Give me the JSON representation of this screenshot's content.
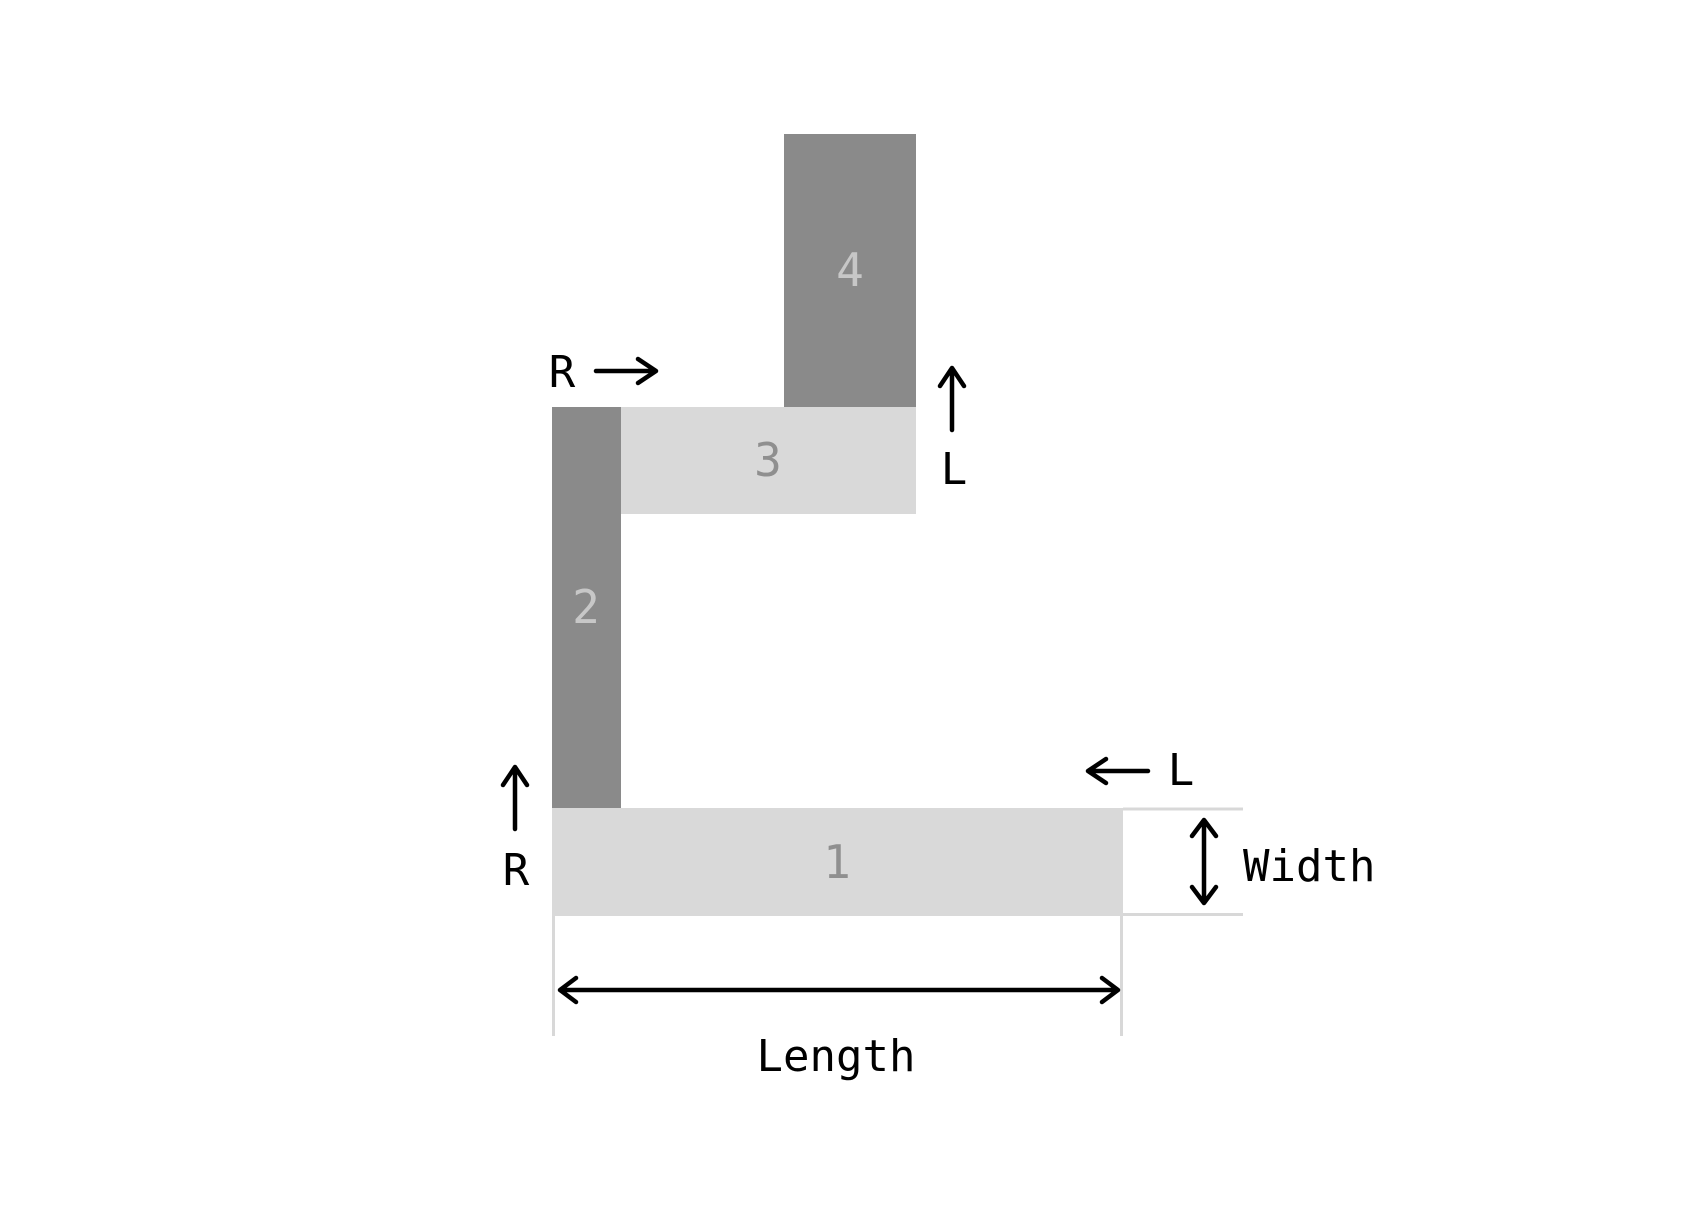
{
  "figure": {
    "pieces": [
      {
        "label": "1"
      },
      {
        "label": "2"
      },
      {
        "label": "3"
      },
      {
        "label": "4"
      }
    ],
    "annotations": {
      "top_r": "R",
      "top_l": "L",
      "mid_l": "L",
      "bottom_r": "R",
      "width_label": "Width",
      "length_label": "Length"
    }
  },
  "colors": {
    "background": "#ffffff",
    "dark_fill": "#8a8a8a",
    "light_fill": "#d9d9d9",
    "label_on_dark": "#c7c7c7",
    "label_on_light": "#8f8f8f",
    "annotation": "#000000",
    "extension_line": "#d8d8d8"
  }
}
